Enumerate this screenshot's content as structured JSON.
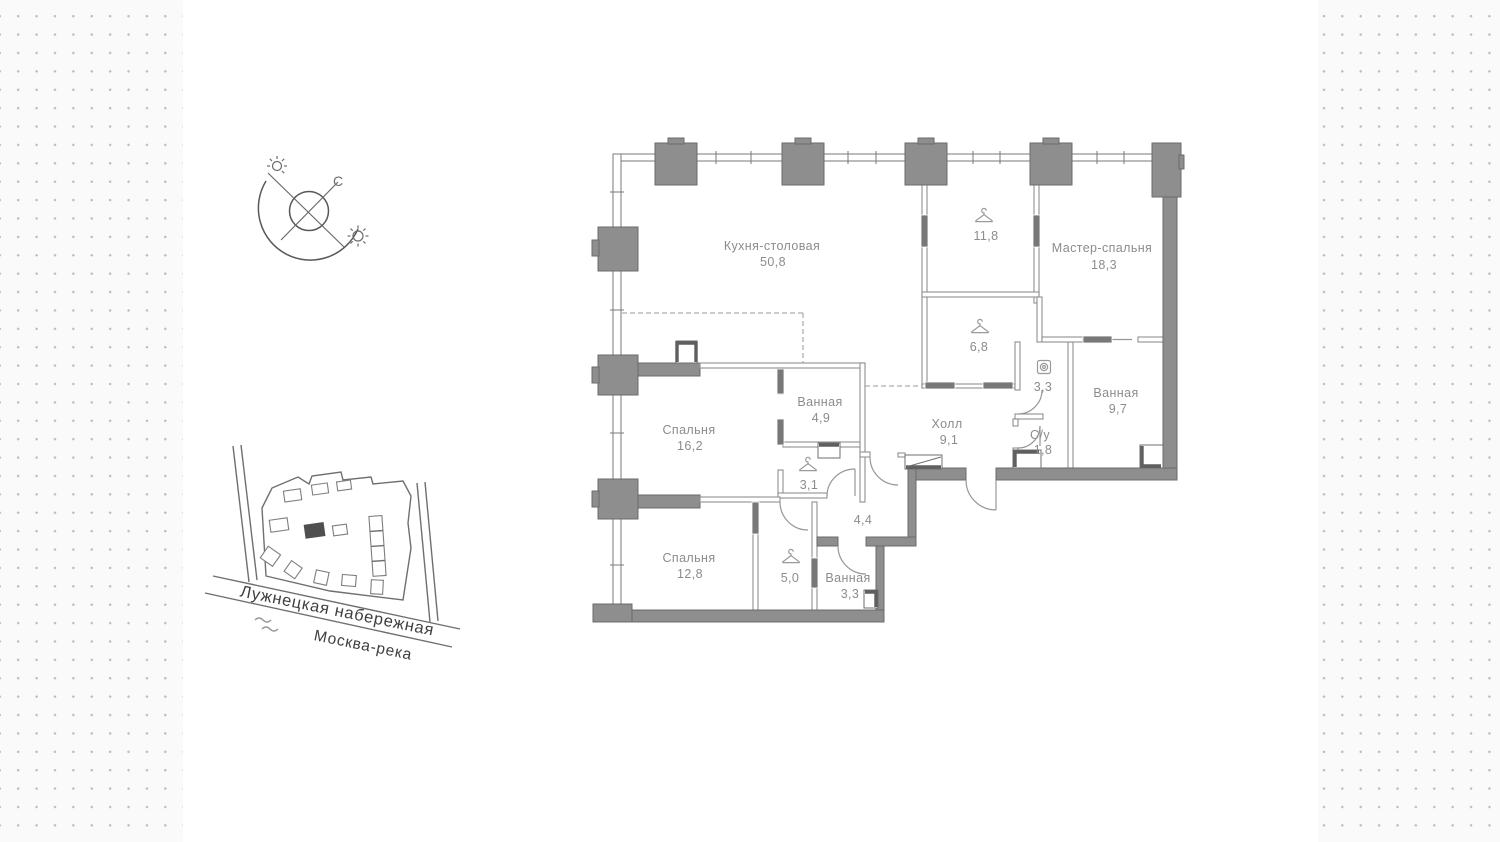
{
  "compass": {
    "north_label": "С"
  },
  "site_map": {
    "street": "Лужнецкая набережная",
    "river": "Москва-река"
  },
  "floor_plan": {
    "rooms": {
      "kitchen": {
        "name": "Кухня-столовая",
        "area": "50,8"
      },
      "wardrobe_118": {
        "area": "11,8",
        "icon": "hanger"
      },
      "master": {
        "name": "Мастер-спальня",
        "area": "18,3"
      },
      "wardrobe_68": {
        "area": "6,8",
        "icon": "hanger"
      },
      "laundry_33": {
        "area": "3,3",
        "icon": "washer"
      },
      "bath_97": {
        "name": "Ванная",
        "area": "9,7"
      },
      "hall": {
        "name": "Холл",
        "area": "9,1"
      },
      "wc_18": {
        "name": "С/у",
        "area": "1,8"
      },
      "bath_49": {
        "name": "Ванная",
        "area": "4,9"
      },
      "bedroom_162": {
        "name": "Спальня",
        "area": "16,2"
      },
      "wardrobe_31": {
        "area": "3,1",
        "icon": "hanger"
      },
      "corridor_44": {
        "area": "4,4"
      },
      "bedroom_128": {
        "name": "Спальня",
        "area": "12,8"
      },
      "wardrobe_50": {
        "area": "5,0",
        "icon": "hanger"
      },
      "bath_33": {
        "name": "Ванная",
        "area": "3,3"
      }
    }
  },
  "colors": {
    "wall_dark": "#8e8e8e",
    "wall_outline": "#6b6b6b",
    "label_text": "#8c8c8c",
    "map_text": "#3e3e3e",
    "background_dot": "#bdbdbd",
    "panel": "#ffffff"
  }
}
